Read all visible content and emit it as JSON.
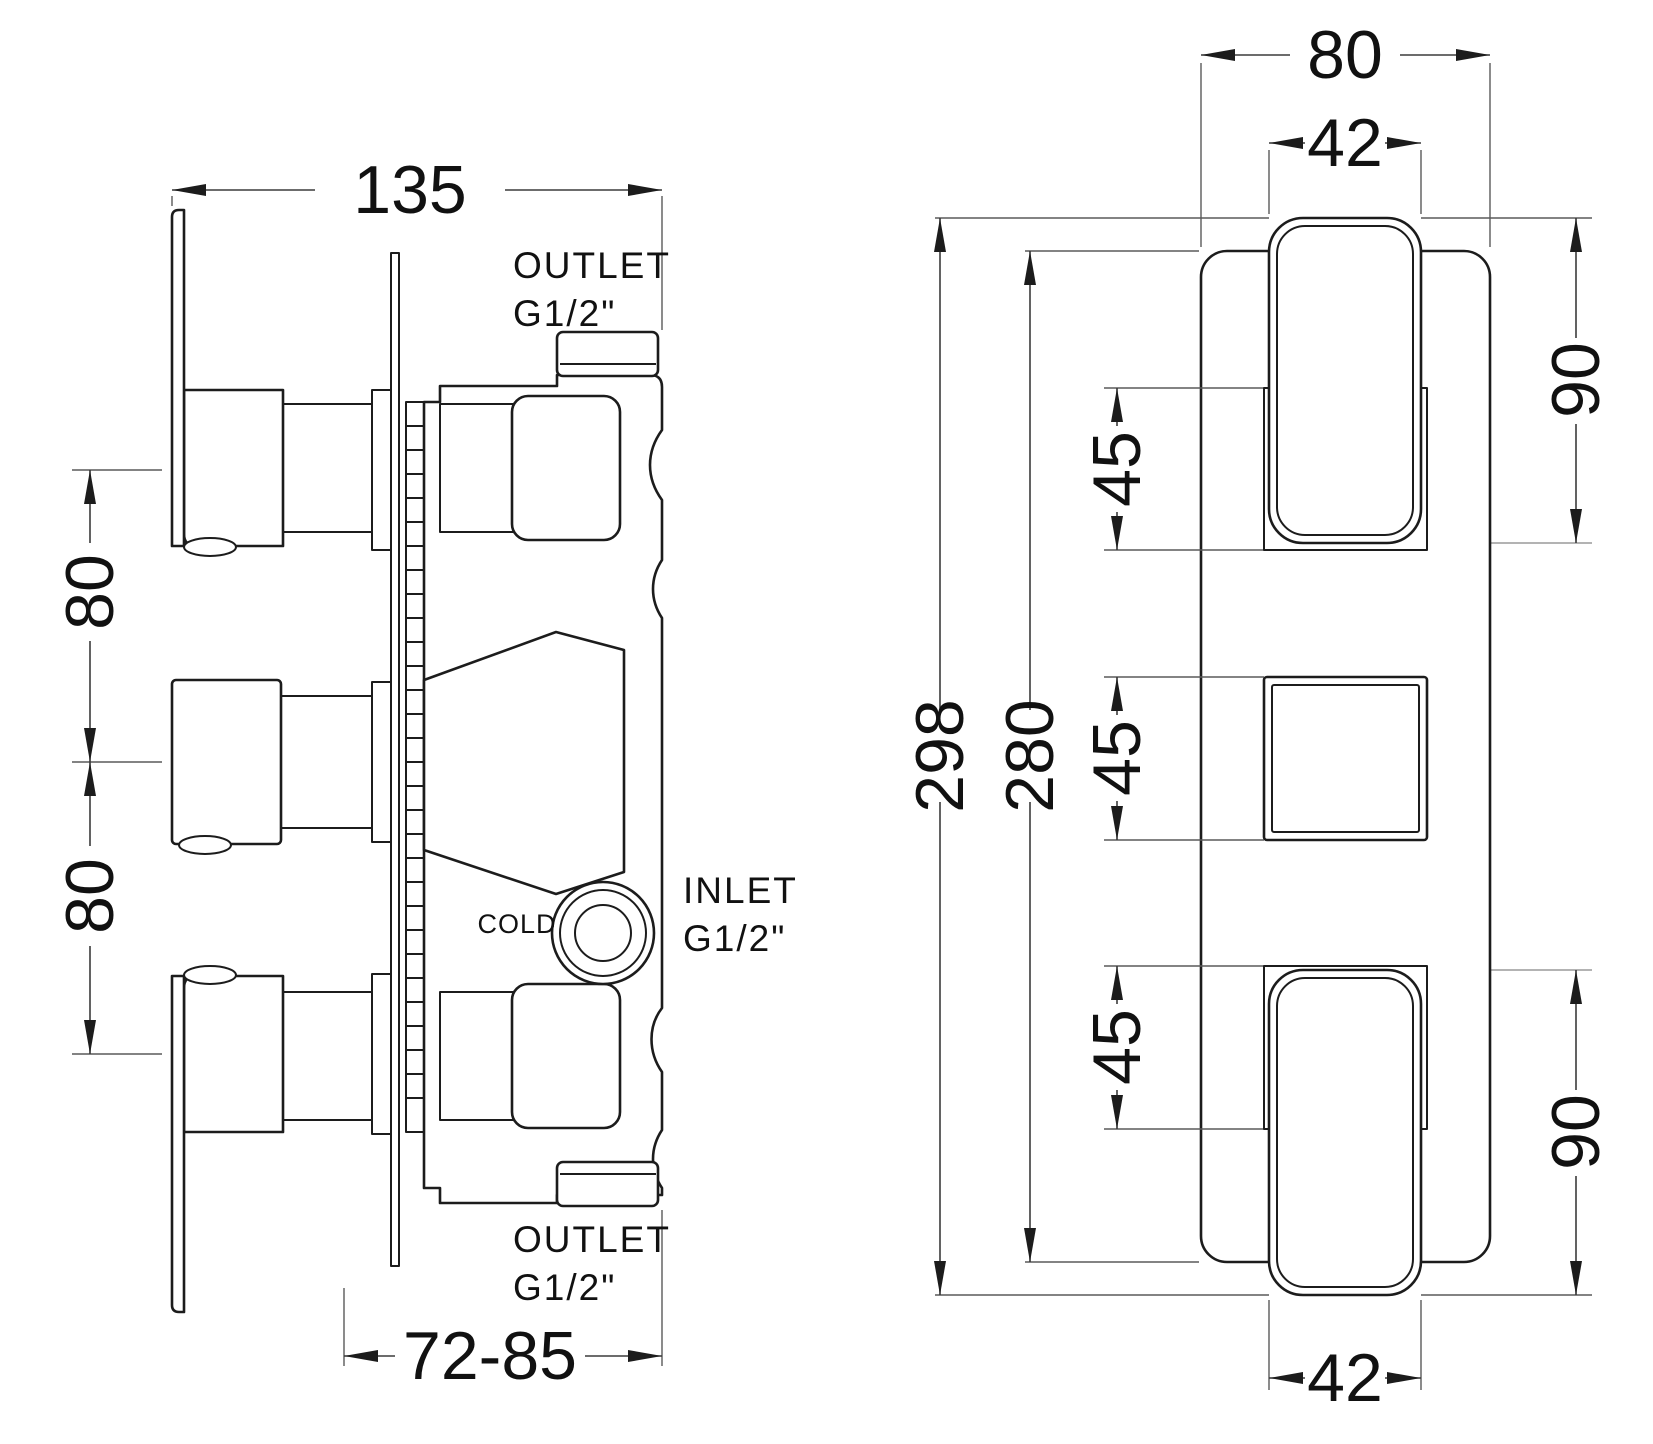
{
  "drawing": {
    "background": "#ffffff",
    "line_color": "#1c1c1c",
    "side_view": {
      "dim_width": "135",
      "dim_spacing": [
        "80",
        "80"
      ],
      "dim_recess": "72-85",
      "outlet_top": [
        "OUTLET",
        "G1/2\""
      ],
      "inlet": [
        "INLET",
        "G1/2\""
      ],
      "outlet_bottom": [
        "OUTLET",
        "G1/2\""
      ],
      "cold": "COLD"
    },
    "front_view": {
      "dim_plate_width": "80",
      "dim_handle_width": [
        "42",
        "42"
      ],
      "dim_overall_height": "298",
      "dim_plate_height": "280",
      "dim_escutcheon": [
        "45",
        "45",
        "45"
      ],
      "dim_handle_height": [
        "90",
        "90"
      ]
    }
  }
}
